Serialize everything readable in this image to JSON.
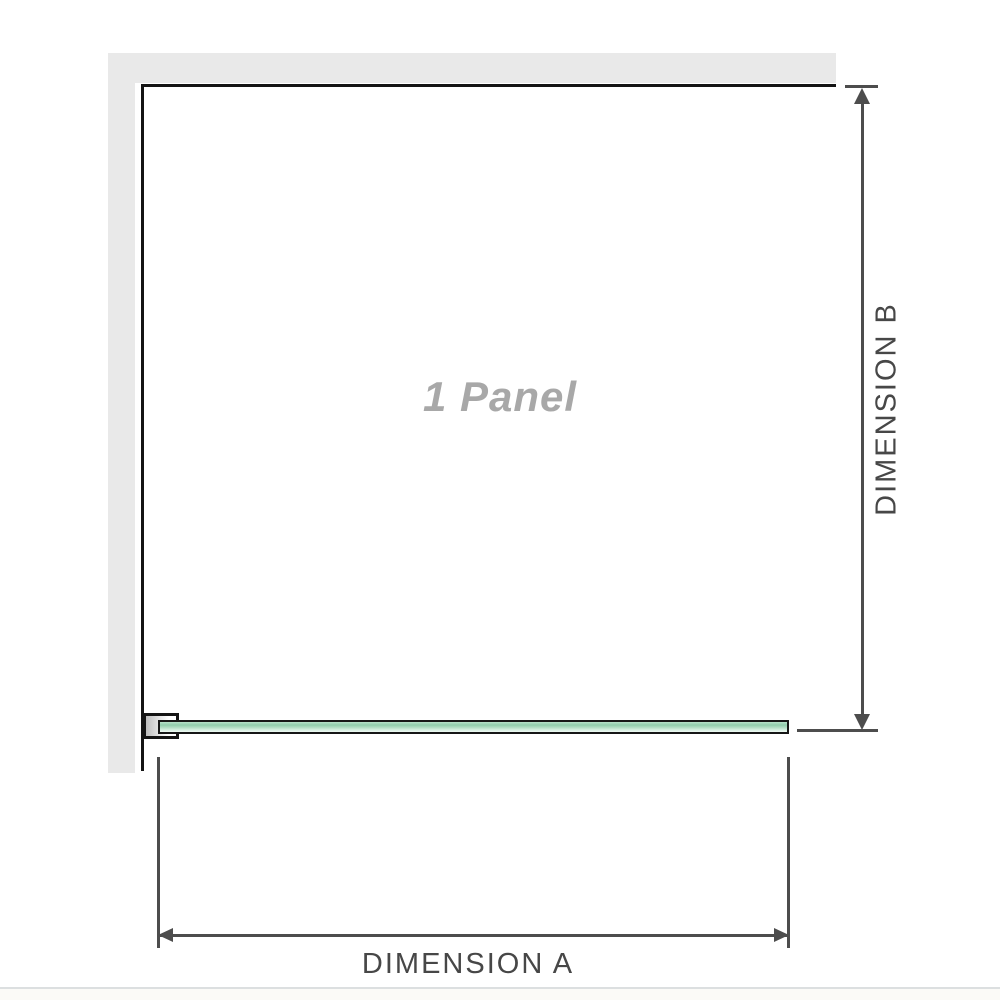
{
  "diagram": {
    "title": "1 panel shower screen dimension diagram",
    "panel_label": "1 Panel",
    "dimension_a_label": "DIMENSION A",
    "dimension_b_label": "DIMENSION B",
    "colors": {
      "wall_gray": "#e9e9e9",
      "outline_black": "#141414",
      "dimension_line_gray": "#4d4d4d",
      "label_gray": "#474747",
      "panel_label_gray": "#a8a8a8",
      "glass_green_dark": "#8fccab",
      "glass_green_light": "#eef8f2",
      "divider_gray": "#dcdfe0"
    }
  }
}
